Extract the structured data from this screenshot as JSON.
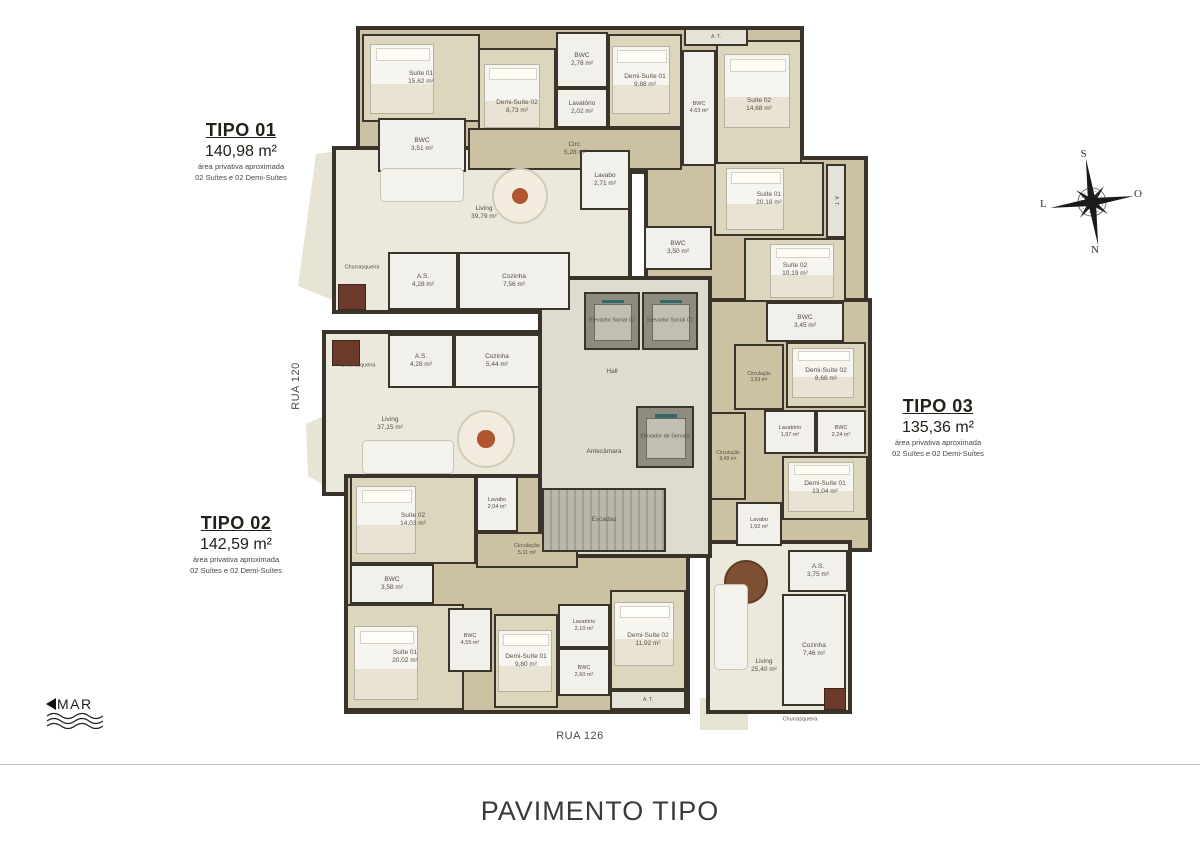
{
  "title": "PAVIMENTO TIPO",
  "streets": {
    "left": "RUA 120",
    "bottom": "RUA 126"
  },
  "sea_label": "MAR",
  "compass": {
    "top": "S",
    "right": "O",
    "bottom": "N",
    "left": "L"
  },
  "colors": {
    "wall": "#3a342b",
    "wood_floor": "#cdc1a3",
    "living_floor": "#ebe8dc",
    "bedroom_floor": "#dcd6bd",
    "bath_floor": "#f1f0eb",
    "core_floor": "#dedbd0",
    "label_text": "#544f46"
  },
  "tipo_cards": [
    {
      "name": "TIPO 01",
      "area": "140,98 m²",
      "sub1": "área privativa aproximada",
      "sub2": "02 Suítes e 02 Demi-Suítes",
      "x": 241,
      "y": 120
    },
    {
      "name": "TIPO 02",
      "area": "142,59 m²",
      "sub1": "área privativa aproximada",
      "sub2": "02 Suítes e 02 Demi-Suítes",
      "x": 236,
      "y": 513
    },
    {
      "name": "TIPO 03",
      "area": "135,36 m²",
      "sub1": "área privativa aproximada",
      "sub2": "02 Suítes e 02 Demi-Suítes",
      "x": 938,
      "y": 396
    }
  ],
  "plan": {
    "blocks": [
      {
        "kind": "wood",
        "x": 356,
        "y": 26,
        "w": 448,
        "h": 148
      },
      {
        "kind": "living",
        "x": 332,
        "y": 146,
        "w": 300,
        "h": 168
      },
      {
        "kind": "living",
        "x": 322,
        "y": 330,
        "w": 224,
        "h": 166
      },
      {
        "kind": "wood",
        "x": 344,
        "y": 474,
        "w": 346,
        "h": 240
      },
      {
        "kind": "wood",
        "x": 644,
        "y": 156,
        "w": 224,
        "h": 154
      },
      {
        "kind": "wood",
        "x": 694,
        "y": 298,
        "w": 178,
        "h": 254
      },
      {
        "kind": "living",
        "x": 706,
        "y": 540,
        "w": 146,
        "h": 174
      },
      {
        "kind": "core",
        "x": 538,
        "y": 276,
        "w": 174,
        "h": 282
      }
    ],
    "balconies": [
      {
        "x": 296,
        "y": 146,
        "w": 66,
        "h": 170,
        "clip": "polygon(20px 8px, 66px 2px, 66px 166px, 2px 140px)"
      },
      {
        "x": 300,
        "y": 400,
        "w": 46,
        "h": 102,
        "clip": "polygon(6px 24px, 46px 6px, 46px 98px, 8px 76px)"
      },
      {
        "x": 700,
        "y": 698,
        "w": 48,
        "h": 32,
        "clip": "polygon(0 0, 48px 0, 48px 32px, 0 32px)"
      }
    ],
    "rooms": [
      {
        "label": "Suíte 01",
        "area": "15,62 m²",
        "x": 362,
        "y": 34,
        "w": 118,
        "h": 88,
        "kind": "bedroom"
      },
      {
        "label": "BWC",
        "area": "3,51 m²",
        "x": 378,
        "y": 118,
        "w": 88,
        "h": 54,
        "kind": "bath"
      },
      {
        "label": "Demi-Suíte 02",
        "area": "8,73 m²",
        "x": 478,
        "y": 48,
        "w": 78,
        "h": 118,
        "kind": "bedroom"
      },
      {
        "label": "BWC",
        "area": "2,78 m²",
        "x": 556,
        "y": 32,
        "w": 52,
        "h": 56,
        "kind": "bath"
      },
      {
        "label": "Lavatório",
        "area": "2,02 m²",
        "x": 556,
        "y": 88,
        "w": 52,
        "h": 40,
        "kind": "bath"
      },
      {
        "label": "Demi-Suíte 01",
        "area": "9,88 m²",
        "x": 608,
        "y": 34,
        "w": 74,
        "h": 94,
        "kind": "bedroom"
      },
      {
        "label": "BWC",
        "area": "4,63 m²",
        "x": 682,
        "y": 50,
        "w": 34,
        "h": 116,
        "kind": "bath",
        "fs": 5.5
      },
      {
        "label": "Suíte 02",
        "area": "14,68 m²",
        "x": 716,
        "y": 40,
        "w": 86,
        "h": 130,
        "kind": "bedroom"
      },
      {
        "label": "A. T.",
        "x": 684,
        "y": 28,
        "w": 64,
        "h": 18,
        "kind": "storage",
        "fs": 5
      },
      {
        "label": "Circ.",
        "area": "5,28 m²",
        "x": 468,
        "y": 128,
        "w": 214,
        "h": 42,
        "kind": "wood"
      },
      {
        "label": "Living",
        "area": "39,79 m²",
        "x": 484,
        "y": 213,
        "kind": "label"
      },
      {
        "label": "Lavabo",
        "area": "2,71 m²",
        "x": 580,
        "y": 150,
        "w": 50,
        "h": 60,
        "kind": "bath"
      },
      {
        "label": "Churrasqueira",
        "x": 362,
        "y": 268,
        "kind": "label",
        "fs": 5.5
      },
      {
        "label": "A.S.",
        "area": "4,28 m²",
        "x": 388,
        "y": 252,
        "w": 70,
        "h": 58,
        "kind": "bath"
      },
      {
        "label": "Cozinha",
        "area": "7,56 m²",
        "x": 458,
        "y": 252,
        "w": 112,
        "h": 58,
        "kind": "bath"
      },
      {
        "label": "Churrasqueira",
        "x": 358,
        "y": 366,
        "kind": "label",
        "fs": 5.5
      },
      {
        "label": "A.S.",
        "area": "4,28 m²",
        "x": 388,
        "y": 334,
        "w": 66,
        "h": 54,
        "kind": "bath"
      },
      {
        "label": "Cozinha",
        "area": "5,44 m²",
        "x": 454,
        "y": 334,
        "w": 86,
        "h": 54,
        "kind": "bath"
      },
      {
        "label": "Living",
        "area": "37,15 m²",
        "x": 390,
        "y": 424,
        "kind": "label"
      },
      {
        "label": "Suíte 02",
        "area": "14,03 m²",
        "x": 350,
        "y": 476,
        "w": 126,
        "h": 88,
        "kind": "bedroom"
      },
      {
        "label": "Lavabo",
        "area": "2,04 m²",
        "x": 476,
        "y": 476,
        "w": 42,
        "h": 56,
        "kind": "bath",
        "fs": 5.5
      },
      {
        "label": "Circulação",
        "area": "5,11 m²",
        "x": 476,
        "y": 532,
        "w": 102,
        "h": 36,
        "kind": "wood",
        "fs": 5.5
      },
      {
        "label": "BWC",
        "area": "3,58 m²",
        "x": 350,
        "y": 564,
        "w": 84,
        "h": 40,
        "kind": "bath"
      },
      {
        "label": "Suíte 01",
        "area": "20,02 m²",
        "x": 346,
        "y": 604,
        "w": 118,
        "h": 106,
        "kind": "bedroom"
      },
      {
        "label": "BWC",
        "area": "4,55 m²",
        "x": 448,
        "y": 608,
        "w": 44,
        "h": 64,
        "kind": "bath",
        "fs": 5.5
      },
      {
        "label": "Demi-Suíte 01",
        "area": "9,80 m²",
        "x": 494,
        "y": 614,
        "w": 64,
        "h": 94,
        "kind": "bedroom"
      },
      {
        "label": "Lavatório",
        "area": "2,10 m²",
        "x": 558,
        "y": 604,
        "w": 52,
        "h": 44,
        "kind": "bath",
        "fs": 5.5
      },
      {
        "label": "BWC",
        "area": "2,60 m²",
        "x": 558,
        "y": 648,
        "w": 52,
        "h": 48,
        "kind": "bath",
        "fs": 5.5
      },
      {
        "label": "Demi-Suíte 02",
        "area": "11,92 m²",
        "x": 610,
        "y": 590,
        "w": 76,
        "h": 100,
        "kind": "bedroom"
      },
      {
        "label": "A. T.",
        "x": 610,
        "y": 690,
        "w": 76,
        "h": 20,
        "kind": "storage",
        "fs": 5
      },
      {
        "label": "Elevador Social 02",
        "x": 584,
        "y": 292,
        "w": 56,
        "h": 58,
        "kind": "elevator",
        "fs": 5.5
      },
      {
        "label": "Elevador Social 01",
        "x": 642,
        "y": 292,
        "w": 56,
        "h": 58,
        "kind": "elevator",
        "fs": 5.5
      },
      {
        "label": "Hall",
        "x": 612,
        "y": 372,
        "kind": "label"
      },
      {
        "label": "Antecâmara",
        "x": 604,
        "y": 452,
        "kind": "label"
      },
      {
        "label": "Elevador de Serviço",
        "x": 636,
        "y": 406,
        "w": 58,
        "h": 62,
        "kind": "elevator",
        "fs": 5.5
      },
      {
        "label": "Escadas",
        "x": 542,
        "y": 488,
        "w": 124,
        "h": 64,
        "kind": "stairs"
      },
      {
        "label": "Suíte 01",
        "area": "20,18 m²",
        "x": 714,
        "y": 162,
        "w": 110,
        "h": 74,
        "kind": "bedroom"
      },
      {
        "label": "A. T.",
        "x": 826,
        "y": 164,
        "w": 20,
        "h": 74,
        "kind": "storage",
        "fs": 5,
        "vert": true
      },
      {
        "label": "BWC",
        "area": "3,50 m²",
        "x": 644,
        "y": 226,
        "w": 68,
        "h": 44,
        "kind": "bath"
      },
      {
        "label": "Suíte 02",
        "area": "10,19 m²",
        "x": 744,
        "y": 238,
        "w": 102,
        "h": 64,
        "kind": "bedroom"
      },
      {
        "label": "BWC",
        "area": "3,45 m²",
        "x": 766,
        "y": 302,
        "w": 78,
        "h": 40,
        "kind": "bath"
      },
      {
        "label": "Circulação",
        "area": "3,93 m²",
        "x": 734,
        "y": 344,
        "w": 50,
        "h": 66,
        "kind": "wood",
        "fs": 5
      },
      {
        "label": "Demi-Suíte 02",
        "area": "8,68 m²",
        "x": 786,
        "y": 342,
        "w": 80,
        "h": 66,
        "kind": "bedroom"
      },
      {
        "label": "Lavatório",
        "area": "1,97 m²",
        "x": 764,
        "y": 410,
        "w": 52,
        "h": 44,
        "kind": "bath",
        "fs": 5.5
      },
      {
        "label": "BWC",
        "area": "2,24 m²",
        "x": 816,
        "y": 410,
        "w": 50,
        "h": 44,
        "kind": "bath",
        "fs": 5.5
      },
      {
        "label": "Circulação",
        "area": "9,49 m²",
        "x": 710,
        "y": 412,
        "w": 36,
        "h": 88,
        "kind": "wood",
        "fs": 5
      },
      {
        "label": "Demi-Suíte 01",
        "area": "13,04 m²",
        "x": 782,
        "y": 456,
        "w": 86,
        "h": 64,
        "kind": "bedroom"
      },
      {
        "label": "Lavabo",
        "area": "1,92 m²",
        "x": 736,
        "y": 502,
        "w": 46,
        "h": 44,
        "kind": "bath",
        "fs": 5.5
      },
      {
        "label": "A.S.",
        "area": "3,75 m²",
        "x": 788,
        "y": 550,
        "w": 60,
        "h": 42,
        "kind": "bath"
      },
      {
        "label": "Cozinha",
        "area": "7,46 m²",
        "x": 782,
        "y": 594,
        "w": 64,
        "h": 112,
        "kind": "bath"
      },
      {
        "label": "Living",
        "area": "25,40 m²",
        "x": 764,
        "y": 666,
        "kind": "label"
      },
      {
        "label": "Churrasqueira",
        "x": 800,
        "y": 720,
        "kind": "label",
        "fs": 5.5
      }
    ],
    "furniture": [
      {
        "type": "bed",
        "x": 370,
        "y": 44,
        "w": 64,
        "h": 70
      },
      {
        "type": "bed",
        "x": 484,
        "y": 64,
        "w": 56,
        "h": 64
      },
      {
        "type": "bed",
        "x": 612,
        "y": 46,
        "w": 58,
        "h": 68
      },
      {
        "type": "bed",
        "x": 724,
        "y": 54,
        "w": 66,
        "h": 74
      },
      {
        "type": "bed",
        "x": 356,
        "y": 486,
        "w": 60,
        "h": 68
      },
      {
        "type": "bed",
        "x": 354,
        "y": 626,
        "w": 64,
        "h": 74
      },
      {
        "type": "bed",
        "x": 498,
        "y": 630,
        "w": 54,
        "h": 62
      },
      {
        "type": "bed",
        "x": 614,
        "y": 602,
        "w": 60,
        "h": 64
      },
      {
        "type": "bed",
        "x": 726,
        "y": 168,
        "w": 58,
        "h": 62
      },
      {
        "type": "bed",
        "x": 770,
        "y": 244,
        "w": 64,
        "h": 54
      },
      {
        "type": "bed",
        "x": 792,
        "y": 348,
        "w": 62,
        "h": 50
      },
      {
        "type": "bed",
        "x": 788,
        "y": 462,
        "w": 66,
        "h": 50
      },
      {
        "type": "table",
        "x": 492,
        "y": 168,
        "w": 56,
        "h": 56
      },
      {
        "type": "table",
        "x": 457,
        "y": 410,
        "w": 58,
        "h": 58
      },
      {
        "type": "darktable",
        "x": 724,
        "y": 560,
        "w": 44,
        "h": 44
      },
      {
        "type": "sofa",
        "x": 380,
        "y": 168,
        "w": 84,
        "h": 34
      },
      {
        "type": "sofa",
        "x": 362,
        "y": 440,
        "w": 92,
        "h": 34
      },
      {
        "type": "sofa",
        "x": 714,
        "y": 584,
        "w": 34,
        "h": 86
      },
      {
        "type": "churras",
        "x": 338,
        "y": 284,
        "w": 28,
        "h": 26
      },
      {
        "type": "churras",
        "x": 332,
        "y": 340,
        "w": 28,
        "h": 26
      },
      {
        "type": "churras",
        "x": 824,
        "y": 688,
        "w": 22,
        "h": 22
      }
    ]
  }
}
